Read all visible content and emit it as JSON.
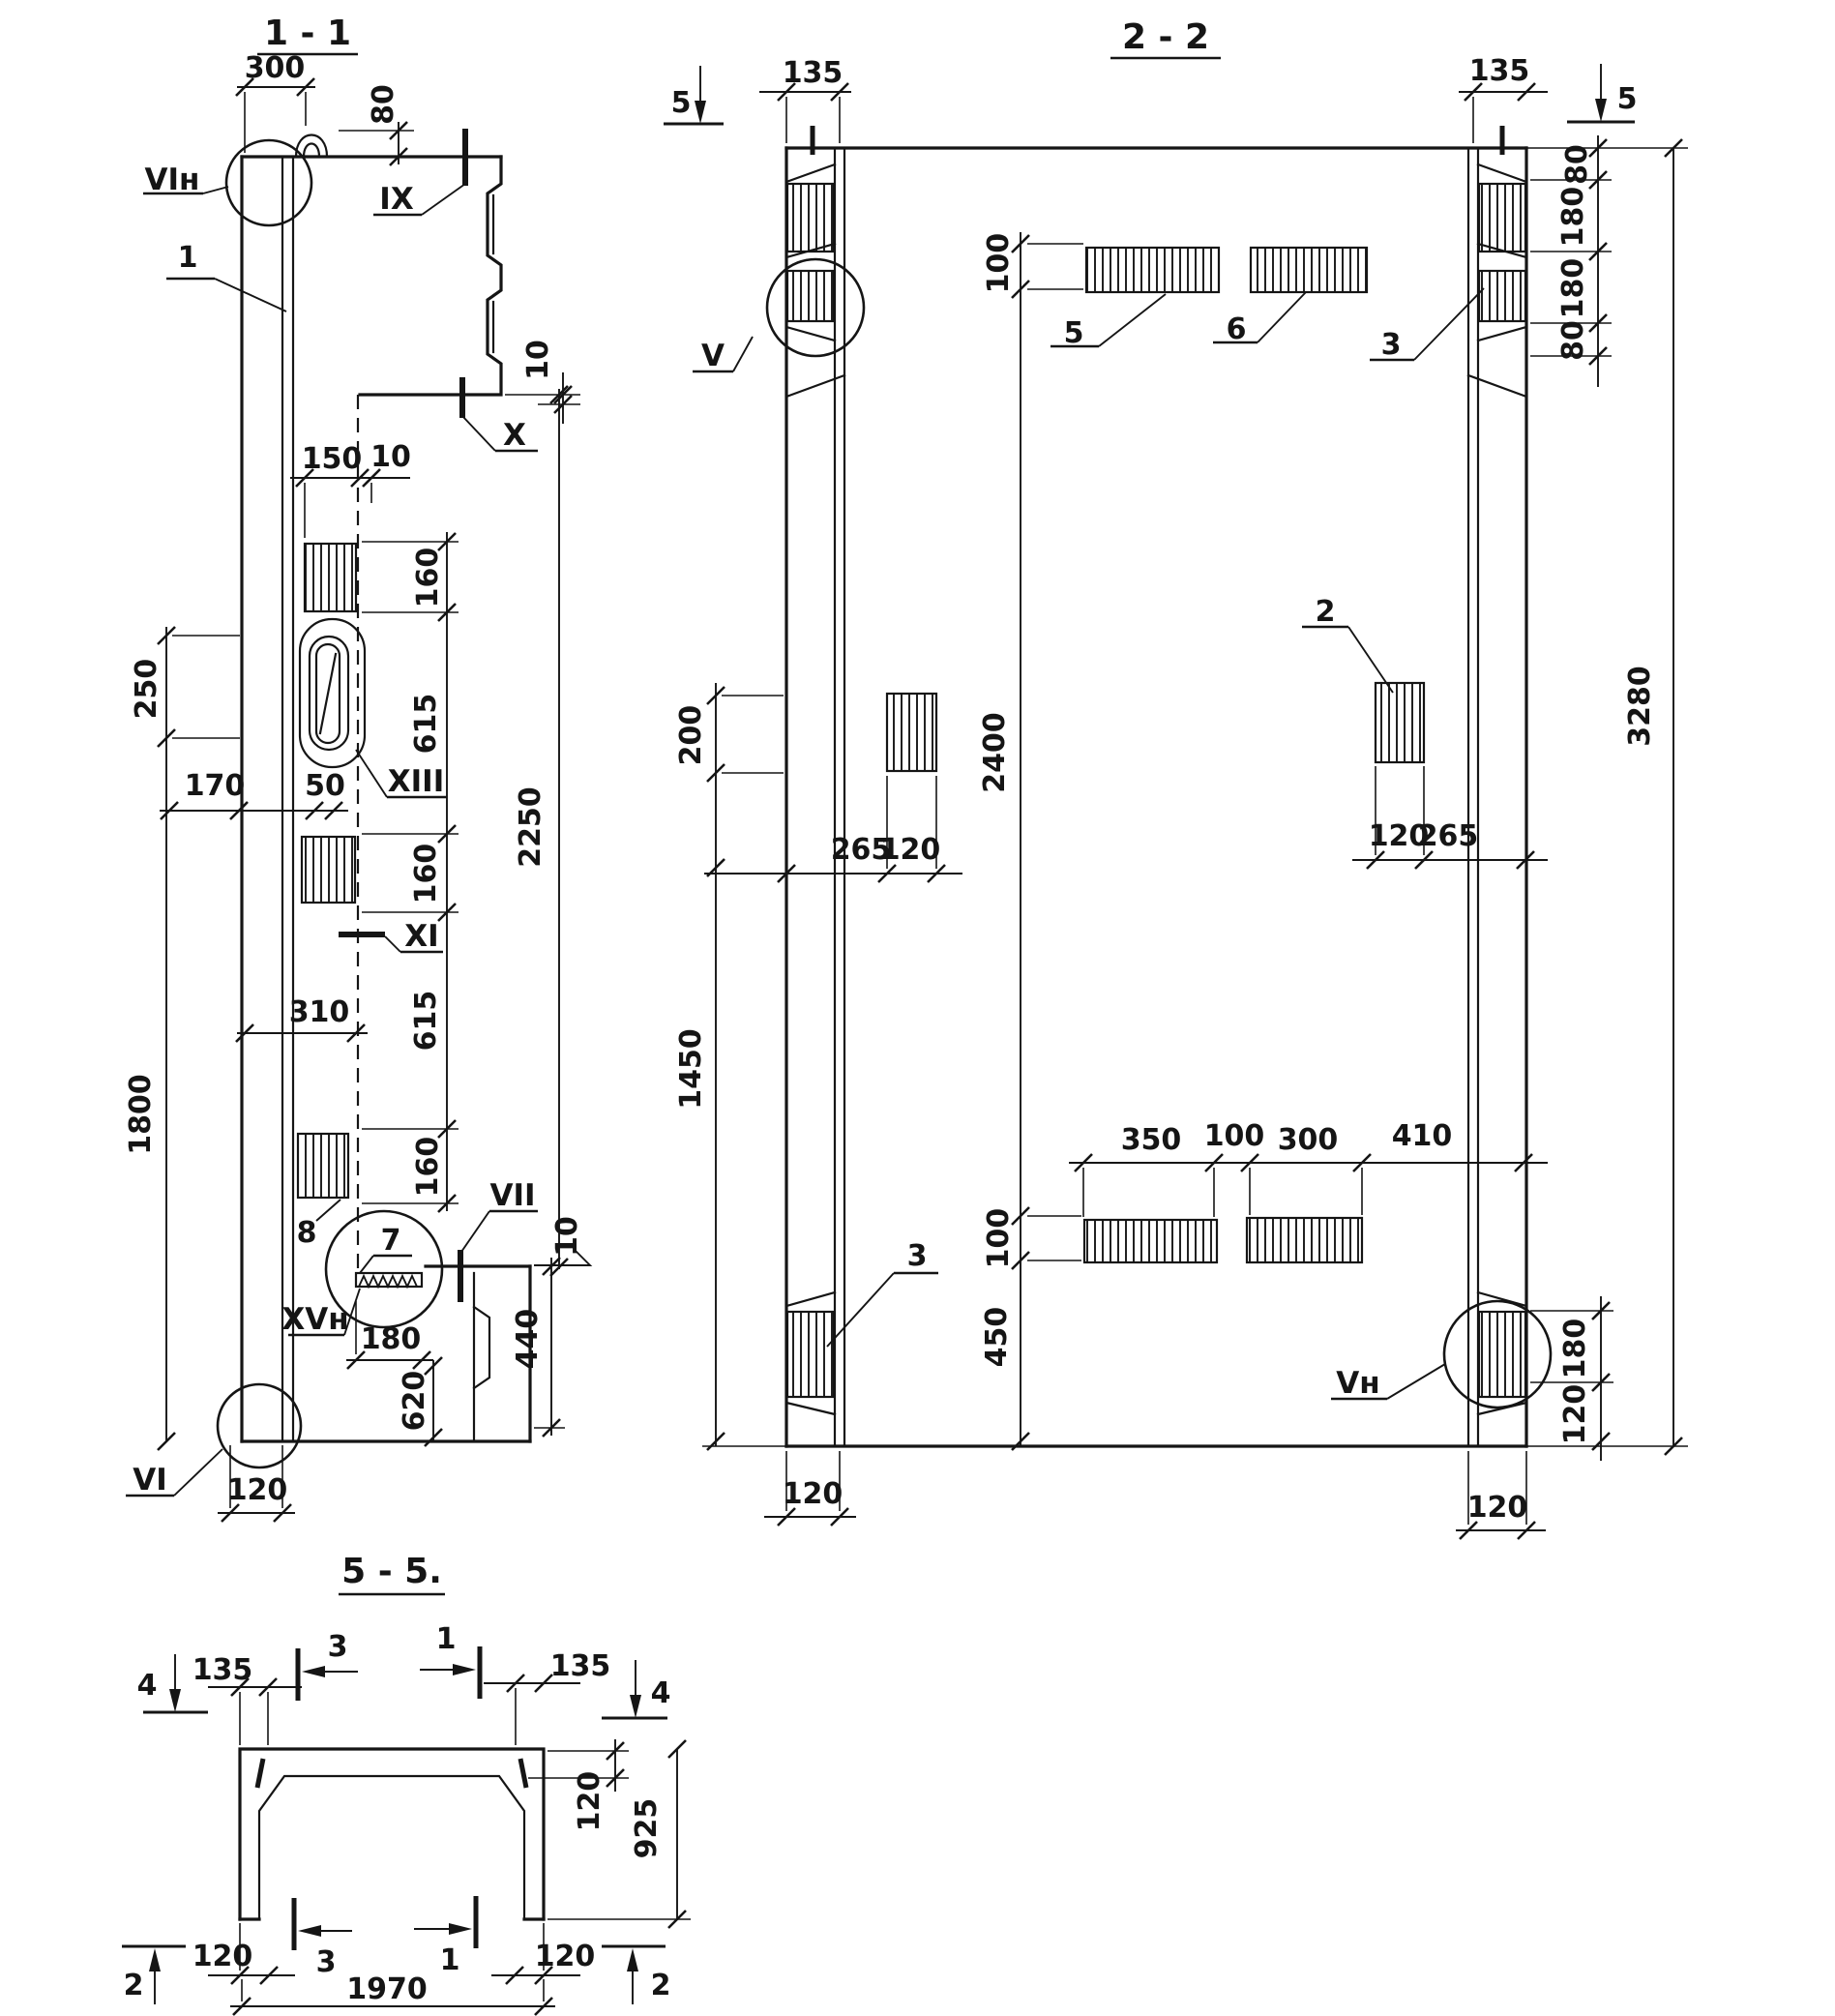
{
  "colors": {
    "ink": "#151515",
    "paper": "#ffffff"
  },
  "s11": {
    "title": "1 - 1",
    "d300": "300",
    "d80": "80",
    "vin": "VIн",
    "ix": "IX",
    "n1": "1",
    "d10a": "10",
    "x": "X",
    "d150": "150",
    "d10b": "10",
    "d160a": "160",
    "d250": "250",
    "d615a": "615",
    "d2250": "2250",
    "d170": "170",
    "d50": "50",
    "xiii": "XIII",
    "d160b": "160",
    "xi": "XI",
    "d310": "310",
    "d615b": "615",
    "d1800": "1800",
    "d160c": "160",
    "n8": "8",
    "n7": "7",
    "vii": "VII",
    "d10c": "10",
    "xvn": "XVн",
    "d180": "180",
    "d620": "620",
    "d440": "440",
    "vi": "VI",
    "d120": "120"
  },
  "s22": {
    "title": "2 - 2",
    "mk5l": "5",
    "d135l": "135",
    "d135r": "135",
    "mk5r": "5",
    "d80a": "80",
    "d180a": "180",
    "d180b": "180",
    "d80b": "80",
    "d100t": "100",
    "n5": "5",
    "n6": "6",
    "n3a": "3",
    "v": "V",
    "d200": "200",
    "d2400": "2400",
    "d3280": "3280",
    "d265l": "265",
    "d120l": "120",
    "n2": "2",
    "d120r": "120",
    "d265r": "265",
    "d1450": "1450",
    "d350": "350",
    "d100m": "100",
    "d300": "300",
    "d410": "410",
    "d100b": "100",
    "d450": "450",
    "n3b": "3",
    "vn": "Vн",
    "d180c": "180",
    "d120c": "120",
    "d120lb": "120",
    "d120rb": "120"
  },
  "s55": {
    "title": "5 - 5.",
    "mk4l": "4",
    "d135l": "135",
    "n3t": "3",
    "n1t": "1",
    "d135r": "135",
    "mk4r": "4",
    "d120s": "120",
    "d925": "925",
    "d120bl": "120",
    "n3b": "3",
    "n1b": "1",
    "d120br": "120",
    "d1970": "1970",
    "mk2l": "2",
    "mk2r": "2"
  }
}
